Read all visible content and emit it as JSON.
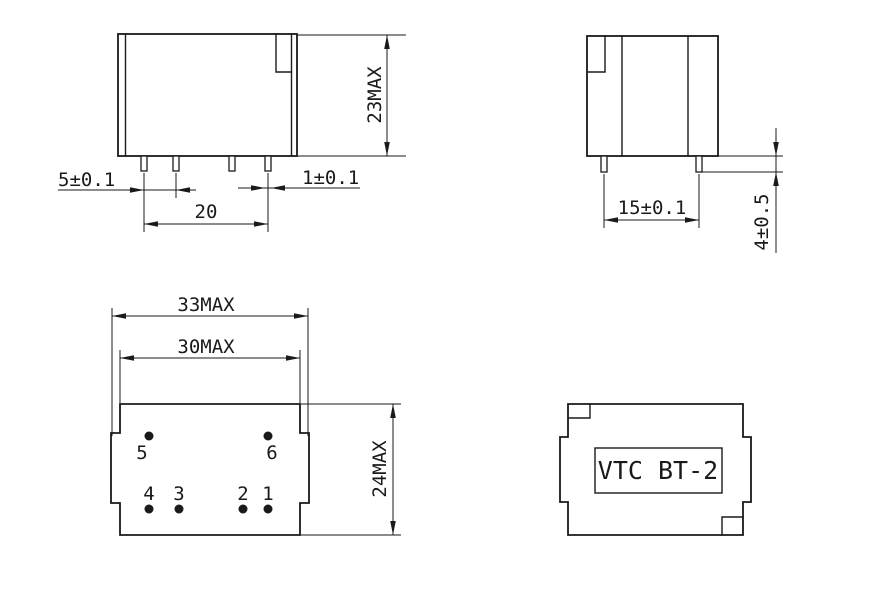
{
  "drawing": {
    "colors": {
      "line": "#1a1a1a",
      "background": "#ffffff",
      "pin_dot": "#000000"
    },
    "views": {
      "front": {
        "dim_pin_pitch": "5±0.1",
        "dim_pin_width": "1±0.1",
        "dim_pin_span": "20",
        "dim_height": "23MAX"
      },
      "side": {
        "dim_pin_pitch": "15±0.1",
        "dim_pin_length": "4±0.5"
      },
      "bottom": {
        "dim_overall_width": "33MAX",
        "dim_body_width": "30MAX",
        "dim_body_depth": "24MAX",
        "pins": [
          "5",
          "6",
          "4",
          "3",
          "2",
          "1"
        ]
      },
      "top": {
        "part_number": "VTC BT-2"
      }
    }
  }
}
